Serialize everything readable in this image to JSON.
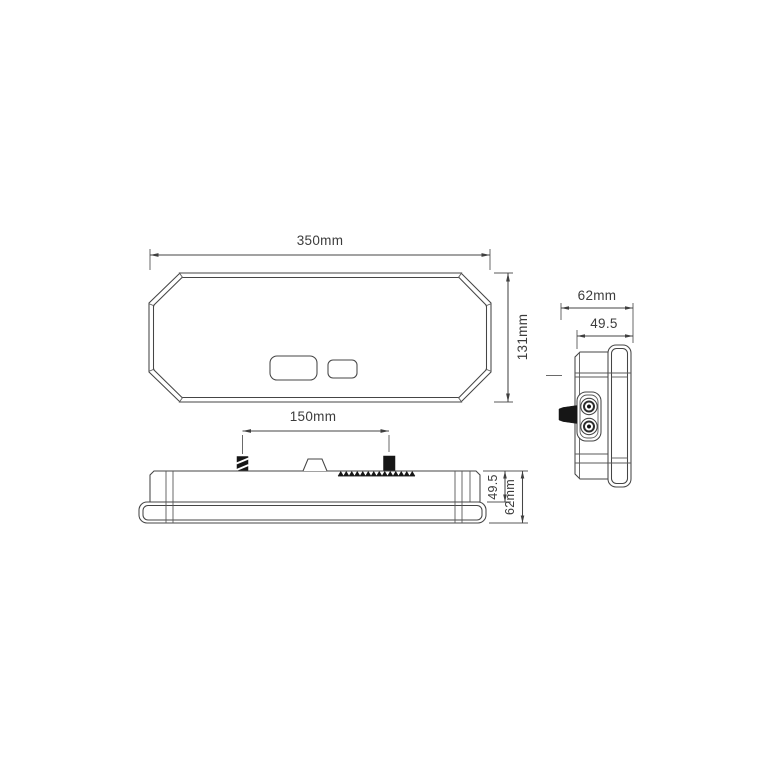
{
  "page": {
    "background_color": "#ffffff"
  },
  "drawing": {
    "line_color": "#454545",
    "text_color": "#3c3c3c",
    "stud_fill_color": "#161616",
    "views": {
      "front": {
        "width_dim": "350mm",
        "height_dim": "131mm"
      },
      "top_profile": {
        "stud_spacing_dim": "150mm",
        "body_depth_dim": "49.5",
        "overall_depth_dim": "62mm"
      },
      "side": {
        "overall_depth_dim": "62mm",
        "body_depth_dim": "49.5"
      }
    }
  }
}
